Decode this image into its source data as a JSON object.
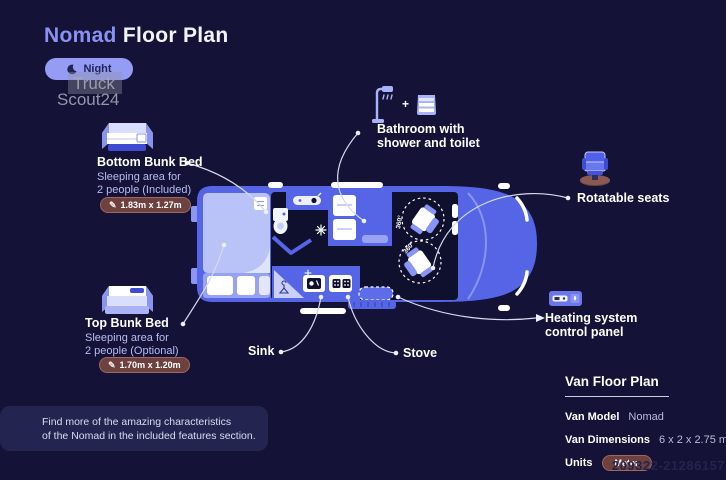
{
  "colors": {
    "background": "#141337",
    "accent": "#8a91f0",
    "van_body": "#5565e6",
    "van_light": "#b9c2f8",
    "interior_dark": "#0f0f2e",
    "badge": "#6e403e",
    "night_pill": "#959cf4",
    "connector": "#d6d9ef"
  },
  "header": {
    "title_accent": "Nomad",
    "title_rest": "Floor Plan"
  },
  "mode_toggle": {
    "label": "Night"
  },
  "watermark": {
    "line1": "Truck",
    "line2": "Scout24"
  },
  "features": {
    "bottom_bunk": {
      "title": "Bottom Bunk Bed",
      "desc1": "Sleeping area for",
      "desc2": "2 people (Included)",
      "dimensions": "1.83m x 1.27m"
    },
    "top_bunk": {
      "title": "Top Bunk Bed",
      "desc1": "Sleeping area for",
      "desc2": "2 people (Optional)",
      "dimensions": "1.70m x 1.20m"
    },
    "bathroom": {
      "plus": "+",
      "line1": "Bathroom with",
      "line2": "shower and toilet"
    },
    "rotatable_seats": {
      "title": "Rotatable seats"
    },
    "heating": {
      "line1": "Heating system",
      "line2": "control panel"
    },
    "sink": {
      "title": "Sink"
    },
    "stove": {
      "title": "Stove"
    }
  },
  "floorplan": {
    "seat_rotation": "360°"
  },
  "info_panel": {
    "title": "Van Floor Plan",
    "rows": [
      {
        "label": "Van Model",
        "value": "Nomad"
      },
      {
        "label": "Van Dimensions",
        "value": "6 x 2 x 2.75 m"
      },
      {
        "label": "Units",
        "value": "Meter"
      }
    ]
  },
  "footer_note": {
    "line1": "Find more of the amazing characteristics",
    "line2": "of the Nomad in the included features section."
  },
  "listing_id": "209322-21286157"
}
